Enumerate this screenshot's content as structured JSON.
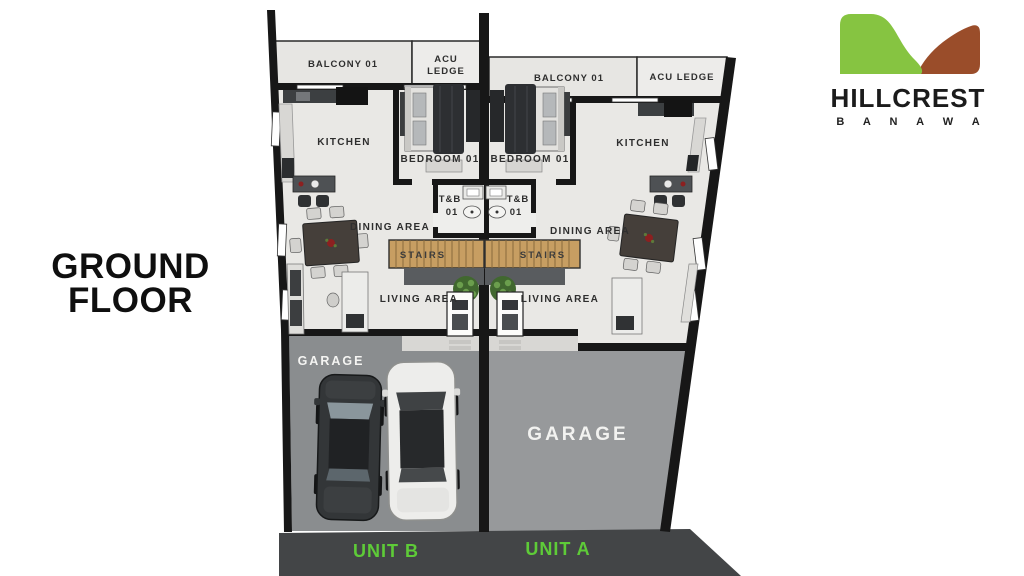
{
  "title": {
    "line1": "GROUND",
    "line2": "FLOOR"
  },
  "logo": {
    "brand": "HILLCREST",
    "location": "B A N A W A"
  },
  "rooms": {
    "balcony": "BALCONY 01",
    "acu": "ACU",
    "ledge": "LEDGE",
    "acu_ledge": "ACU LEDGE",
    "kitchen": "KITCHEN",
    "bedroom": "BEDROOM 01",
    "tnb": "T&B",
    "tnb_num": "01",
    "dining": "DINING AREA",
    "stairs": "STAIRS",
    "living": "LIVING AREA",
    "garage": "GARAGE"
  },
  "units": {
    "left": "UNIT B",
    "right": "UNIT A"
  },
  "colors": {
    "logo_green": "#86c441",
    "logo_brown": "#9a4d2a",
    "unit_label_green": "#5ecb38",
    "wall_black": "#171717",
    "floor_light": "#e9e8e5",
    "balcony_gray": "#e7e6e3",
    "garage_left_gray": "#8a8d8f",
    "garage_right_gray": "#97999b",
    "street_dark": "#434547",
    "stairs_wood": "#c79e62"
  }
}
